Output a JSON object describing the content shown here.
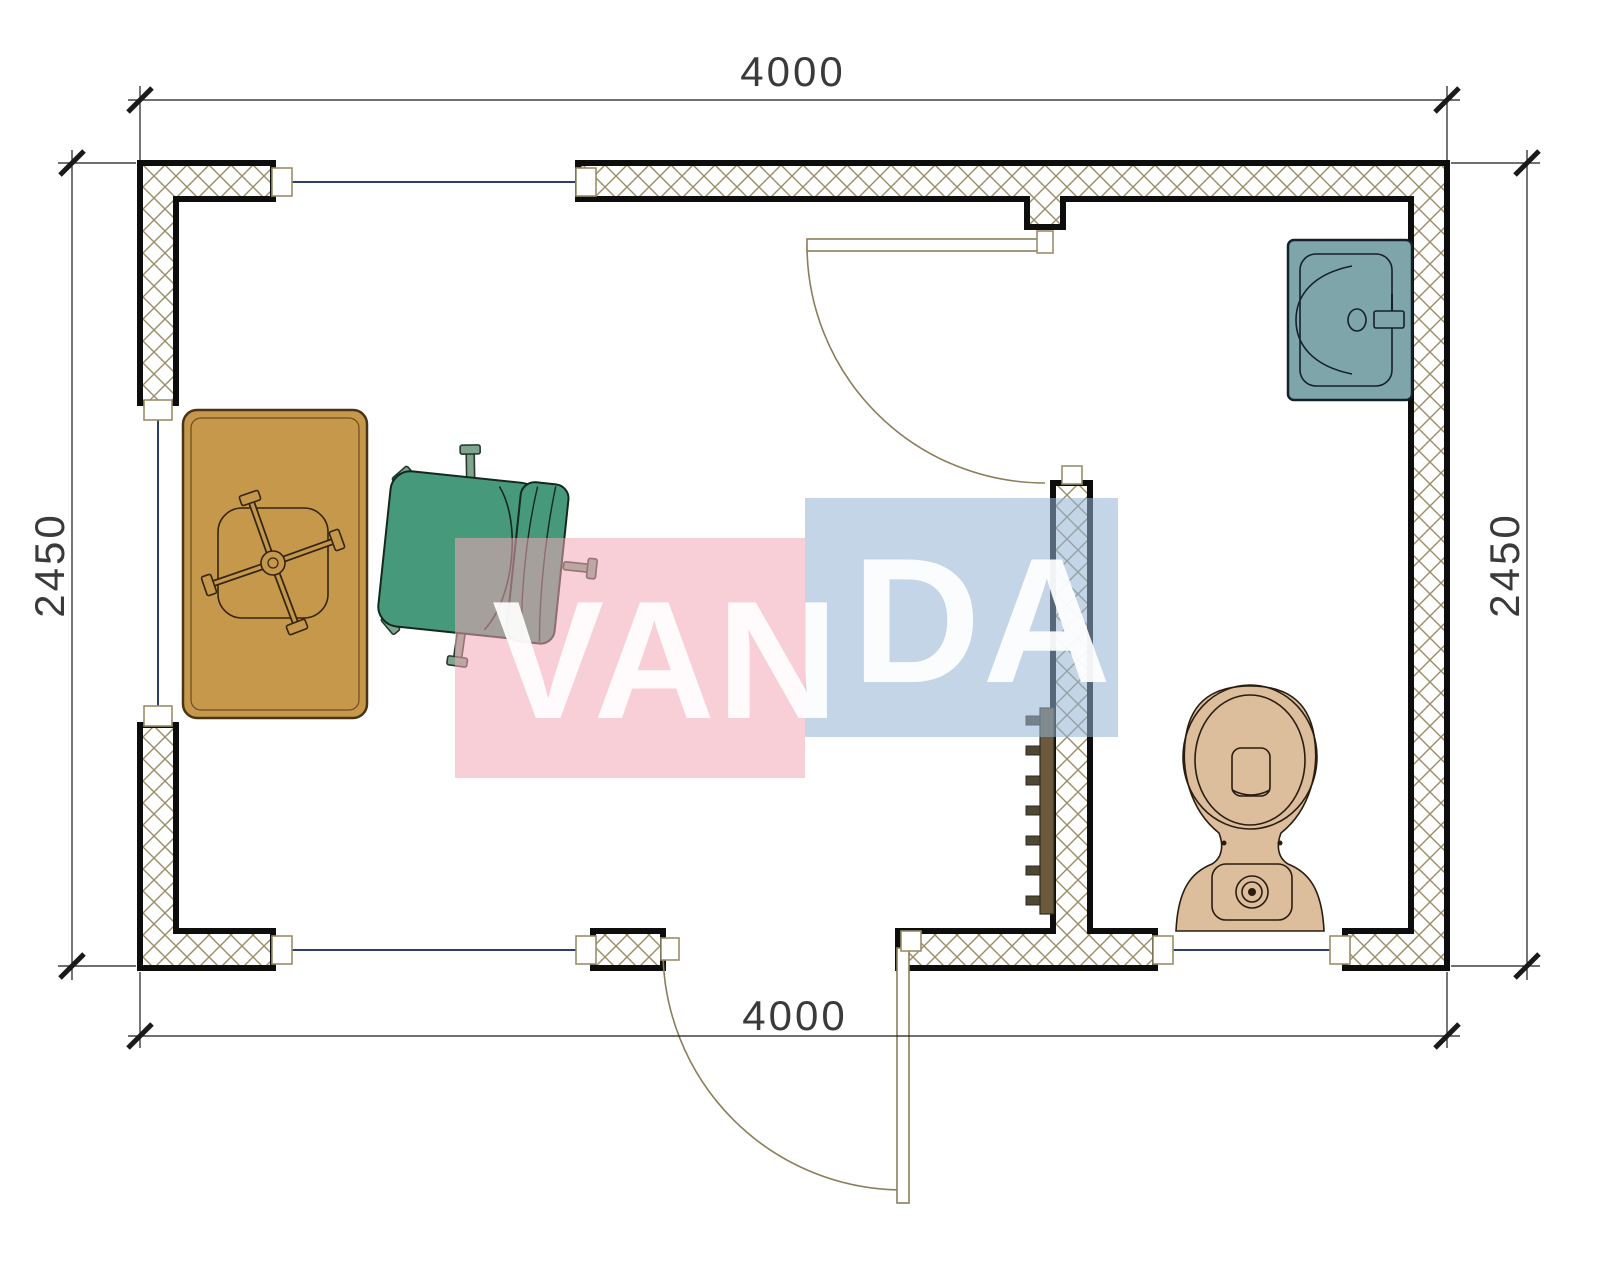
{
  "page": {
    "type": "architectural-floor-plan",
    "canvas_width": 1600,
    "canvas_height": 1280
  },
  "dimensions": {
    "top": "4000",
    "bottom": "4000",
    "left": "2450",
    "right": "2450"
  },
  "watermark": {
    "text": "VANDA",
    "part1": "VAN",
    "part2": "DA",
    "pink_color": "#f2a6b7",
    "blue_color": "#94b2d6",
    "text_color": "#ffffff"
  },
  "colors": {
    "desk": "#c6984c",
    "chair": "#47997b",
    "chair_leg": "#7fa68c",
    "sink": "#7ea5aa",
    "toilet": "#dcbd9c",
    "rack": "#6b5a3b",
    "rack_hook": "#4f4734",
    "wall_hatch": "#9a8e68",
    "wall_outline": "#0d0d0d",
    "window_line": "#2e3c72",
    "door_line": "#8a7f5c",
    "dimension_line": "#1a1a1a"
  },
  "symbols": {
    "desk": "desk",
    "chair": "office-chair",
    "chair_base": "chair-star-base",
    "sink": "washbasin",
    "toilet": "toilet",
    "rack": "coat-hooks",
    "door_top": "bathroom-door",
    "door_bottom": "entrance-door"
  }
}
